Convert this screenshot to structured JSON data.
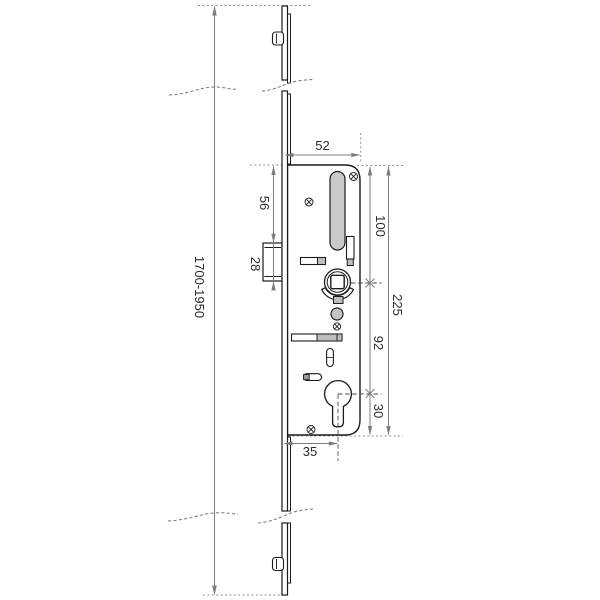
{
  "drawing": {
    "kind": "technical-drawing-multipoint-lock",
    "background": "#ffffff",
    "colors": {
      "part_outline": "#1c1c1c",
      "dimension_line": "#7d7d7d",
      "extension_dots": "#8f8f8f",
      "centerline": "#4a4a4a",
      "slot_fill": "#c9c9c9",
      "small_part_fill": "#bdbdbd",
      "label_text": "#2b2b2b"
    },
    "components": [
      "faceplate-rail",
      "top-roller-cam",
      "bottom-roller-cam",
      "break-lines",
      "lock-case",
      "slot-cutout",
      "screw-cross-marks",
      "latch-bolt",
      "auxiliary-bolt",
      "spindle-hub",
      "spring-arc",
      "deadbolt",
      "oval-cutout",
      "lever-pin",
      "euro-cylinder-hole",
      "centerline-markers"
    ],
    "dimensions": {
      "case_width_top": "52",
      "case_top_to_block": "56",
      "block_height": "28",
      "rail_length_range": "1700-1950",
      "case_top_to_spindle": "100",
      "case_total_height": "225",
      "spindle_to_cylinder": "92",
      "cylinder_to_case_bottom": "30",
      "cylinder_backset": "35"
    }
  }
}
